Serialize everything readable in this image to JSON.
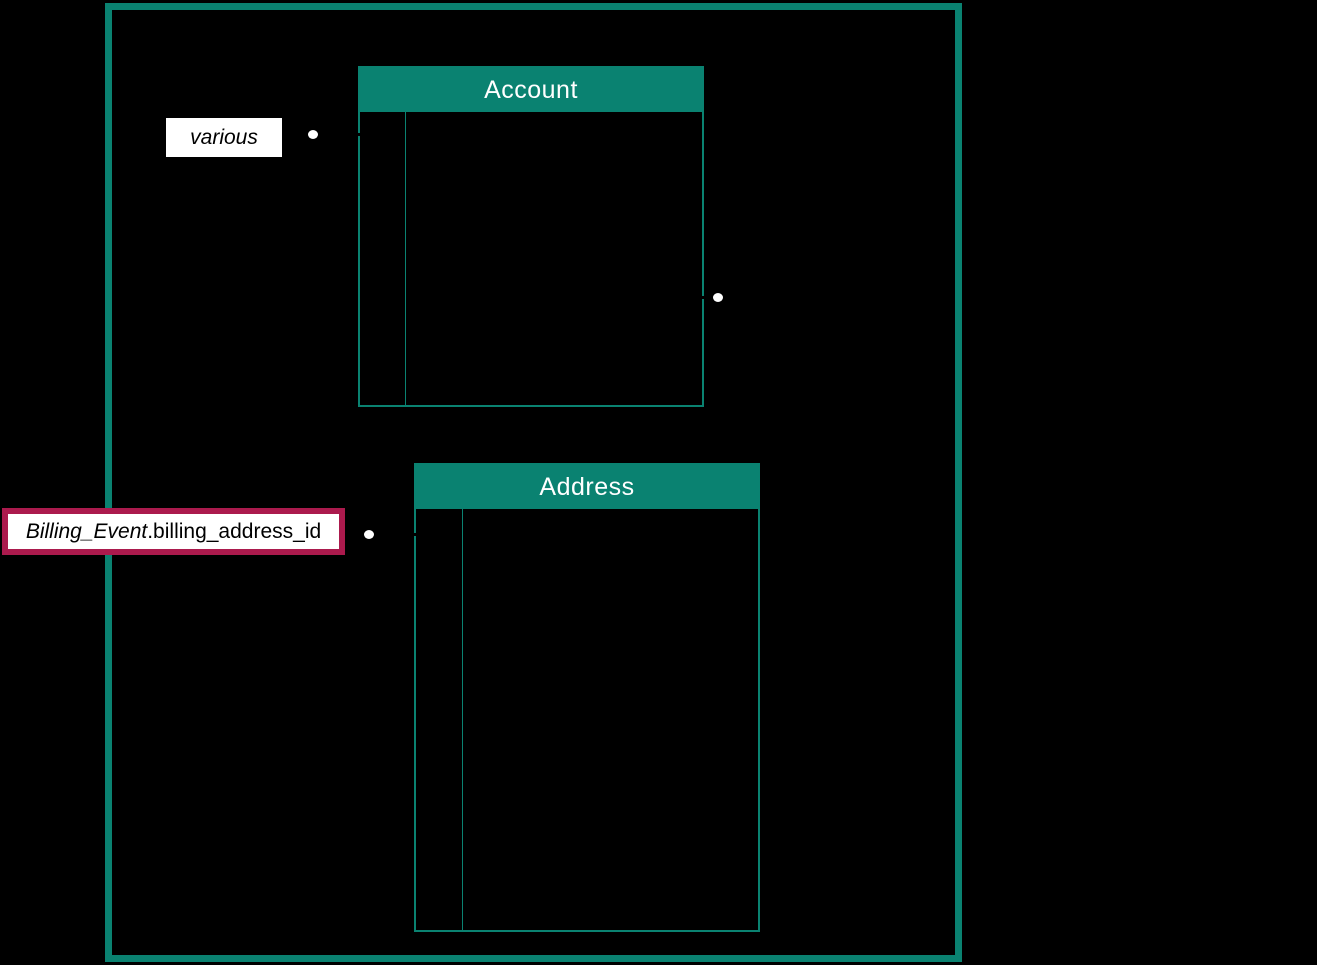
{
  "canvas": {
    "width_px": 1317,
    "height_px": 965,
    "background": "#000000"
  },
  "colors": {
    "boundary_and_table_accent": "#0A8271",
    "highlight_border": "#AB1A4D",
    "label_background": "#FFFFFF",
    "header_text": "#FFFFFF",
    "label_text": "#000000",
    "connector_dot": "#FFFFFF"
  },
  "tables": [
    {
      "title": "Account"
    },
    {
      "title": "Address"
    }
  ],
  "labels": [
    {
      "italic": "various",
      "regular": ""
    },
    {
      "italic": "Billing_Event",
      "regular": ".billing_address_id"
    }
  ],
  "icons": [
    {
      "name": "connector-endpoint-dot",
      "shape": "white-ellipse"
    }
  ]
}
